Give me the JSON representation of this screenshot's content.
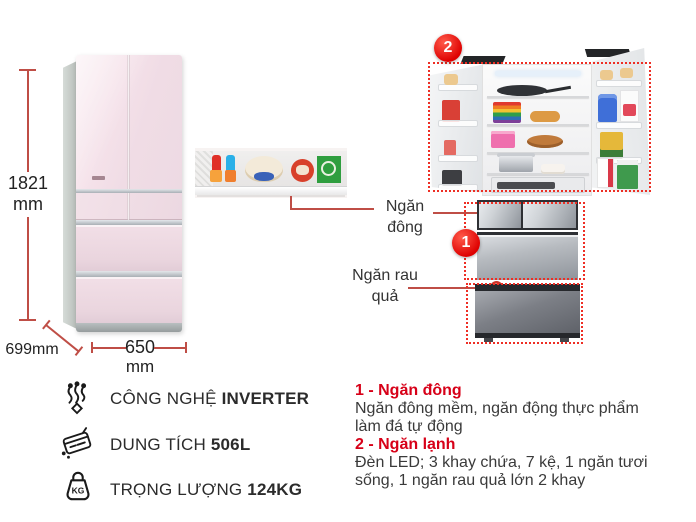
{
  "colors": {
    "accent_red": "#d70018",
    "badge_red": "#e60012",
    "outline_red": "#ee2e24",
    "dim_line_red": "#bf4e46",
    "text_dark": "#2b2b2b"
  },
  "dimensions": {
    "height_value": "1821",
    "height_unit": "mm",
    "depth_label": "699mm",
    "width_value": "650",
    "width_unit": "mm"
  },
  "callouts": {
    "badge_top": "2",
    "badge_bottom": "1",
    "freezer": {
      "line1": "Ngăn",
      "line2": "đông"
    },
    "vegetable": {
      "line1": "Ngăn rau",
      "line2": "quả"
    }
  },
  "features": [
    {
      "icon": "inverter-icon",
      "label": "CÔNG NGHỆ",
      "value": "INVERTER"
    },
    {
      "icon": "capacity-icon",
      "label": "DUNG TÍCH",
      "value": "506L"
    },
    {
      "icon": "weight-icon",
      "label": "TRỌNG LƯỢNG",
      "value": "124KG",
      "icon_text": "KG"
    }
  ],
  "descriptions": [
    {
      "title": "1 - Ngăn đông",
      "body": "Ngăn đông mềm, ngăn động thực phẩm làm đá tự động"
    },
    {
      "title": "2 - Ngăn lạnh",
      "body": "Đèn LED; 3 khay chứa, 7 kệ, 1 ngăn tươi sống, 1 ngăn rau quả lớn 2 khay"
    }
  ]
}
